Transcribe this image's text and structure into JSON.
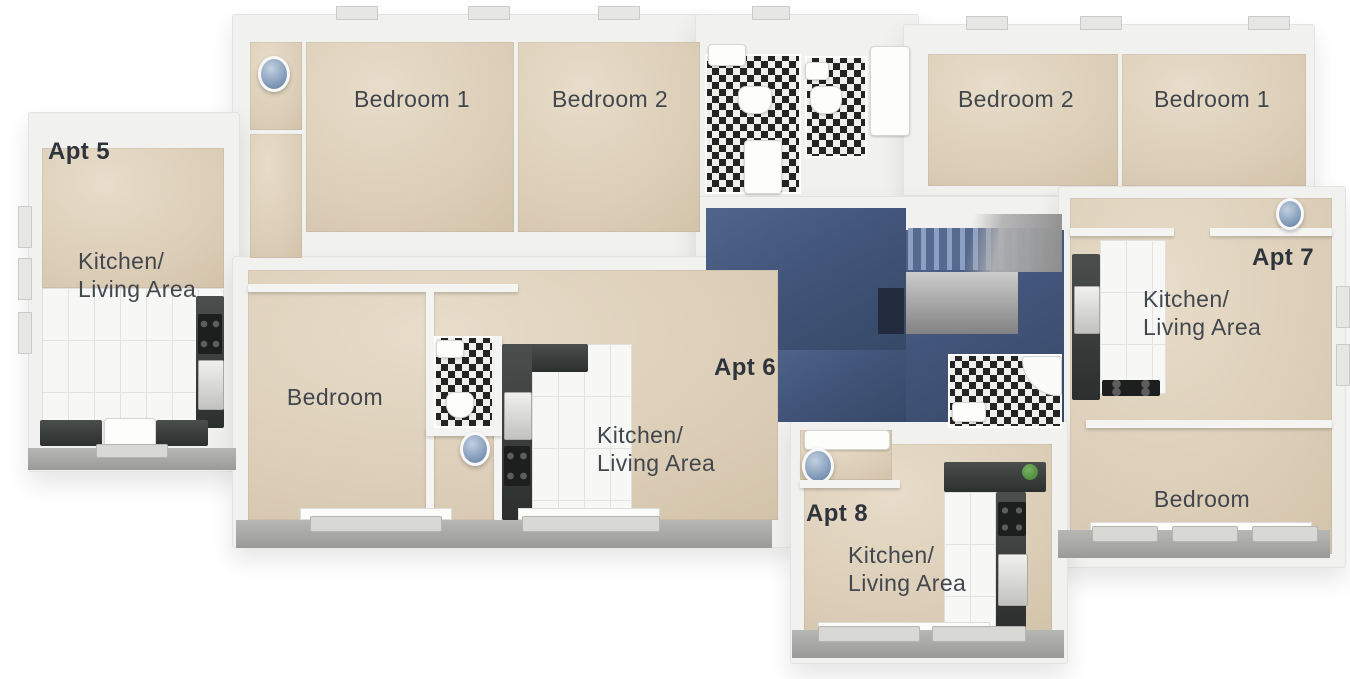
{
  "apartments": {
    "apt5": {
      "name": "Apt 5",
      "rooms": {
        "kitchen_living_line1": "Kitchen/",
        "kitchen_living_line2": "Living Area",
        "bedroom_1": "Bedroom 1",
        "bedroom_2": "Bedroom 2"
      }
    },
    "apt6": {
      "name": "Apt 6",
      "rooms": {
        "kitchen_living_line1": "Kitchen/",
        "kitchen_living_line2": "Living Area",
        "bedroom": "Bedroom"
      }
    },
    "apt7": {
      "name": "Apt 7",
      "rooms": {
        "kitchen_living_line1": "Kitchen/",
        "kitchen_living_line2": "Living Area",
        "bedroom_2": "Bedroom 2",
        "bedroom_1": "Bedroom 1",
        "bedroom": "Bedroom"
      }
    },
    "apt8": {
      "name": "Apt 8",
      "rooms": {
        "kitchen_living_line1": "Kitchen/",
        "kitchen_living_line2": "Living Area"
      }
    }
  },
  "colors": {
    "background": "#ffffff",
    "wall_slab": "#f1f1f0",
    "floor_beige": "#d9cbb4",
    "hall_carpet_blue": "#47597b",
    "stair_tread_blue": "#8ba0c2",
    "bathroom_tile_black": "#242424",
    "bathroom_tile_white": "#efefec",
    "kitchen_tile_white": "#f7f7f5",
    "counter_charcoal": "#3a3e3c",
    "ledge_gray": "#a6a6a6",
    "label_text": "#42474e",
    "apt_label_text": "#2e343c",
    "bin_blue": "#8ba6c3"
  }
}
